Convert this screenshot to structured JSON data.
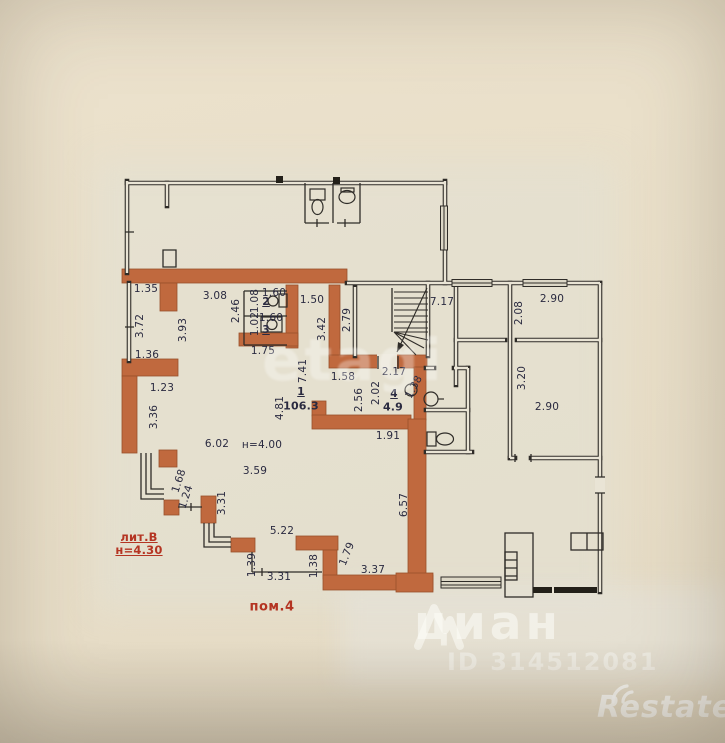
{
  "plan": {
    "colors": {
      "wall_orange": "#c0693e",
      "wall_orange_border": "#99512b",
      "wall_black": "#2f2c28",
      "paper": "#e9e4d5",
      "dim_text": "#2a2a40",
      "red_text": "#b43422"
    },
    "labels": [
      {
        "text": "1.35",
        "x": 146,
        "y": 289
      },
      {
        "text": "3.08",
        "x": 215,
        "y": 296
      },
      {
        "text": "2.46",
        "x": 236,
        "y": 311,
        "rot": -90
      },
      {
        "text": "1.08",
        "x": 255,
        "y": 301,
        "rot": -90
      },
      {
        "text": "1.60",
        "x": 274,
        "y": 293
      },
      {
        "text": "2",
        "x": 266,
        "y": 302,
        "cls": "room-num"
      },
      {
        "text": "1.02",
        "x": 255,
        "y": 324,
        "rot": -90
      },
      {
        "text": "1.60",
        "x": 271,
        "y": 318
      },
      {
        "text": "3",
        "x": 266,
        "y": 330,
        "cls": "room-num"
      },
      {
        "text": "1.75",
        "x": 263,
        "y": 351
      },
      {
        "text": "1.50",
        "x": 312,
        "y": 300
      },
      {
        "text": "3.42",
        "x": 322,
        "y": 329,
        "rot": -90
      },
      {
        "text": "2.79",
        "x": 347,
        "y": 320,
        "rot": -90
      },
      {
        "text": "7.17",
        "x": 442,
        "y": 302
      },
      {
        "text": "2.90",
        "x": 552,
        "y": 299
      },
      {
        "text": "2.08",
        "x": 519,
        "y": 313,
        "rot": -90
      },
      {
        "text": "3.20",
        "x": 522,
        "y": 378,
        "rot": -90
      },
      {
        "text": "2.90",
        "x": 547,
        "y": 407
      },
      {
        "text": "7.41",
        "x": 303,
        "y": 371,
        "rot": -90
      },
      {
        "text": "1.58",
        "x": 343,
        "y": 377
      },
      {
        "text": "2.17",
        "x": 394,
        "y": 372
      },
      {
        "text": "1",
        "x": 301,
        "y": 392,
        "cls": "room-num"
      },
      {
        "text": "106.3",
        "x": 301,
        "y": 406,
        "cls": "area"
      },
      {
        "text": "2.56",
        "x": 359,
        "y": 400,
        "rot": -90
      },
      {
        "text": "2.02",
        "x": 376,
        "y": 393,
        "rot": -90
      },
      {
        "text": "4",
        "x": 394,
        "y": 394,
        "cls": "room-num"
      },
      {
        "text": "4.9",
        "x": 393,
        "y": 407,
        "cls": "area"
      },
      {
        "text": "1.38",
        "x": 414,
        "y": 387,
        "rot": -62
      },
      {
        "text": "1.91",
        "x": 388,
        "y": 436
      },
      {
        "text": "4.81",
        "x": 280,
        "y": 408,
        "rot": -90
      },
      {
        "text": "6.02",
        "x": 217,
        "y": 444
      },
      {
        "text": "н=4.00",
        "x": 262,
        "y": 445
      },
      {
        "text": "3.59",
        "x": 255,
        "y": 471
      },
      {
        "text": "6.57",
        "x": 404,
        "y": 505,
        "rot": -90
      },
      {
        "text": "3.72",
        "x": 140,
        "y": 326,
        "rot": -90
      },
      {
        "text": "3.93",
        "x": 183,
        "y": 330,
        "rot": -90
      },
      {
        "text": "1.36",
        "x": 147,
        "y": 355
      },
      {
        "text": "1.23",
        "x": 162,
        "y": 388
      },
      {
        "text": "3.36",
        "x": 154,
        "y": 417,
        "rot": -90
      },
      {
        "text": "1.68",
        "x": 179,
        "y": 481,
        "rot": -72
      },
      {
        "text": "1.24",
        "x": 186,
        "y": 497,
        "rot": -72
      },
      {
        "text": "3.31",
        "x": 222,
        "y": 503,
        "rot": -90
      },
      {
        "text": "5.22",
        "x": 282,
        "y": 531
      },
      {
        "text": "1.39",
        "x": 252,
        "y": 565,
        "rot": -90
      },
      {
        "text": "3.31",
        "x": 279,
        "y": 577
      },
      {
        "text": "1.38",
        "x": 314,
        "y": 566,
        "rot": -90
      },
      {
        "text": "1.79",
        "x": 347,
        "y": 554,
        "rot": -68
      },
      {
        "text": "3.37",
        "x": 373,
        "y": 570
      },
      {
        "text": "лит.В",
        "x": 139,
        "y": 537,
        "cls": "red underline"
      },
      {
        "text": "н=4.30",
        "x": 139,
        "y": 550,
        "cls": "red underline"
      },
      {
        "text": "пом.4",
        "x": 272,
        "y": 607,
        "cls": "red big"
      }
    ]
  },
  "watermarks": {
    "etagi": "etagi",
    "cian": "циан",
    "cian_id": "ID 314512081",
    "restate": "Restate"
  }
}
